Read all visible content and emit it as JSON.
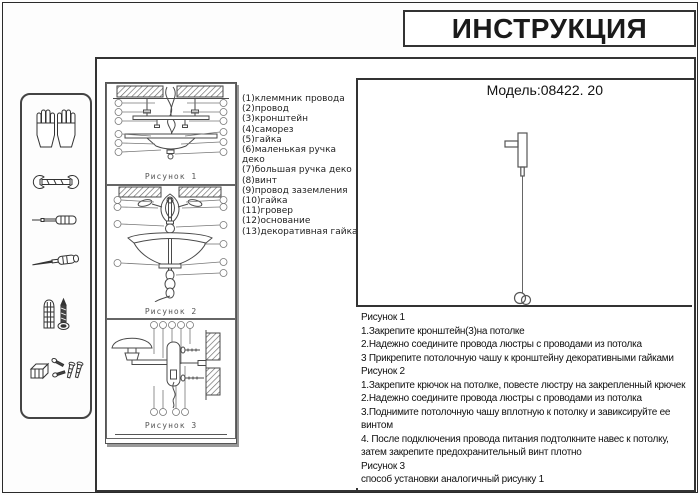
{
  "header": {
    "title": "ИНСТРУКЦИЯ",
    "model": "Модель:08422. 20"
  },
  "sidebar": {
    "icons": [
      "gloves-icon",
      "wrench-icon",
      "screwdriver-icon",
      "awl-icon",
      "anchor-and-screw-icon",
      "fasteners-icon"
    ]
  },
  "parts_list": "(1)клеммник провода\n(2)провод\n(3)кронштейн\n(4)саморез\n(5)гайка\n(6)маленькая ручка деко\n(7)большая ручка деко\n(8)винт\n(9)провод заземления\n(10)гайка\n(11)гровер\n(12)основание\n(13)декоративная гайка",
  "figures": {
    "fig1_label": "Рисунок 1",
    "fig2_label": "Рисунок 2",
    "fig3_label": "Рисунок 3"
  },
  "instructions_text": "Рисунок 1\n1.Закрепите кронштейн(3)на потолке\n2.Надежно соедините провода люстры с проводами из потолка\n3 Прикрепите потолочную чашу к кронштейну декоративными гайками\nРисунок 2\n1.Закрепите крючок на потолке, повесте люстру на закрепленный крючек\n2.Надежно соедините провода люстры с проводами из потолка\n3.Поднимите потолочную чашу вплотную к потолку и завиксируйте ее\nвинтом\n4.  После подключения провода питания подтолкните навес к потолку,\nзатем закрепите предохранительный винт плотно\nРисунок 3\nспособ установки аналогичный рисунку 1",
  "colors": {
    "line": "#4a4a4a",
    "border": "#333333",
    "label_gray": "#555555"
  }
}
